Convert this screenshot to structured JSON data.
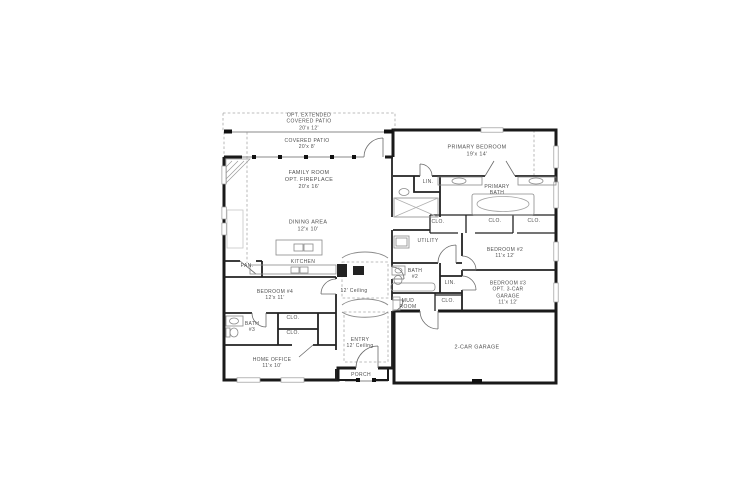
{
  "page": {
    "background": "#ffffff"
  },
  "floor_plan": {
    "description": "Single-story residential floor plan",
    "wall_color": "#1a1a1a",
    "line_color": "#8a8a8a",
    "text_color": "#4f4f4f",
    "rooms": [
      {
        "id": "opt-extended-covered-patio",
        "label": "OPT. EXTENDED\nCOVERED PATIO\n20'x 12'"
      },
      {
        "id": "covered-patio",
        "label": "COVERED PATIO\n20'x 8'"
      },
      {
        "id": "primary-bedroom",
        "label": "PRIMARY BEDROOM\n19'x 14'"
      },
      {
        "id": "family-room",
        "label": "FAMILY ROOM\nOPT. FIREPLACE\n20'x 16'"
      },
      {
        "id": "linen-closet-1",
        "label": "LIN."
      },
      {
        "id": "primary-bath",
        "label": "PRIMARY\nBATH"
      },
      {
        "id": "dining-area",
        "label": "DINING AREA\n12'x 10'"
      },
      {
        "id": "closet-1",
        "label": "CLO."
      },
      {
        "id": "closet-2",
        "label": "CLO."
      },
      {
        "id": "closet-3",
        "label": "CLO."
      },
      {
        "id": "utility",
        "label": "UTILITY"
      },
      {
        "id": "bedroom-2",
        "label": "BEDROOM #2\n11'x 12'"
      },
      {
        "id": "pantry",
        "label": "PAN."
      },
      {
        "id": "kitchen",
        "label": "KITCHEN"
      },
      {
        "id": "bath-2",
        "label": "BATH\n#2"
      },
      {
        "id": "bedroom-4",
        "label": "BEDROOM #4\n12'x 11'"
      },
      {
        "id": "hall-ceiling",
        "label": "12' Ceiling"
      },
      {
        "id": "linen-closet-2",
        "label": "LIN."
      },
      {
        "id": "bedroom-3",
        "label": "BEDROOM #3\nOPT. 3-CAR\nGARAGE\n11'x 12'"
      },
      {
        "id": "mud-room",
        "label": "MUD\nROOM"
      },
      {
        "id": "closet-4",
        "label": "CLO."
      },
      {
        "id": "closet-5",
        "label": "CLO."
      },
      {
        "id": "bath-3",
        "label": "BATH\n#3"
      },
      {
        "id": "closet-6",
        "label": "CLO."
      },
      {
        "id": "entry",
        "label": "ENTRY\n12' Ceiling"
      },
      {
        "id": "home-office",
        "label": "HOME OFFICE\n11'x 10'"
      },
      {
        "id": "porch",
        "label": "PORCH"
      },
      {
        "id": "garage",
        "label": "2-CAR GARAGE"
      }
    ]
  }
}
